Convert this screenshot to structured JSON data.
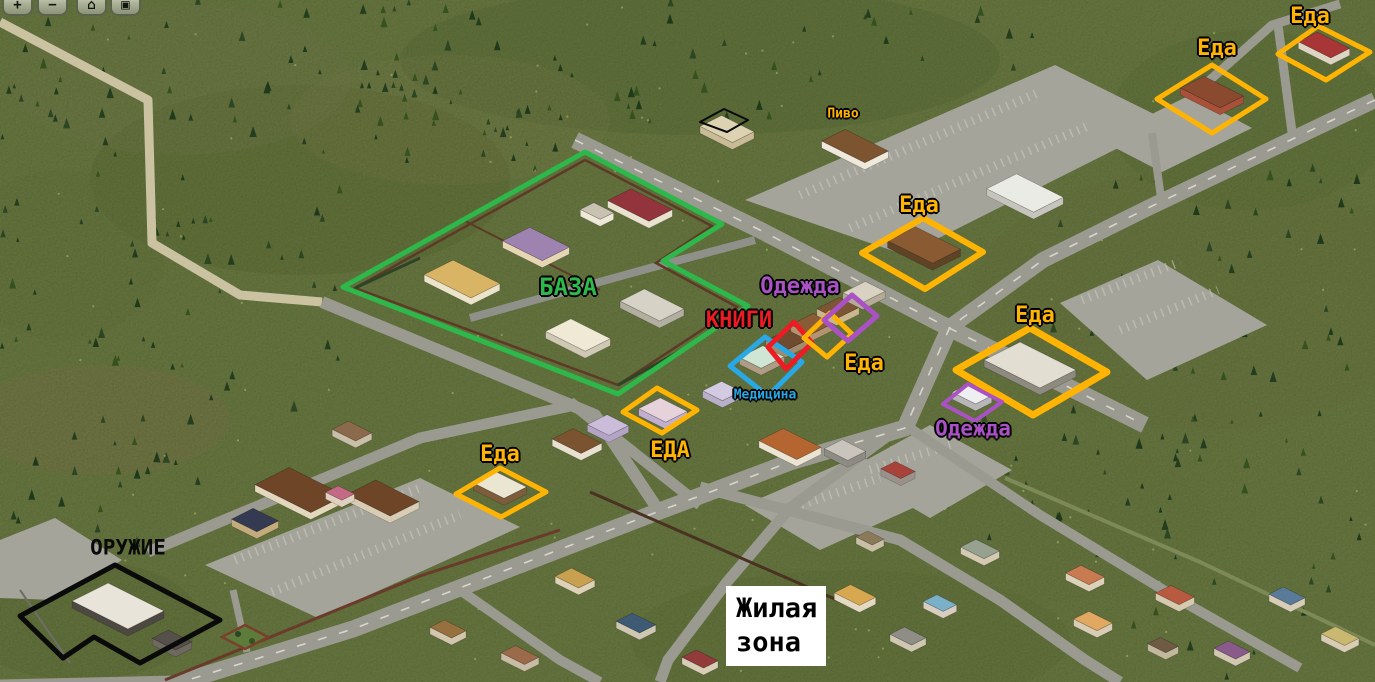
{
  "toolbar": {
    "buttons": [
      {
        "name": "zoom-in",
        "glyph": "+"
      },
      {
        "name": "zoom-out",
        "glyph": "−"
      },
      {
        "name": "home",
        "glyph": "⌂"
      },
      {
        "name": "save",
        "glyph": "▣"
      }
    ]
  },
  "palette": {
    "yellow": "#FFB404",
    "green": "#2EB84B",
    "red": "#ED1C24",
    "blue": "#29A8E6",
    "purple": "#AA52C5",
    "black": "#0A0A0A",
    "white": "#FFFFFF"
  },
  "annotations": {
    "outlines": [
      {
        "id": "base-outline",
        "color_key": "green",
        "width": 5,
        "points": [
          [
            585,
            152
          ],
          [
            722,
            224
          ],
          [
            663,
            261
          ],
          [
            748,
            306
          ],
          [
            618,
            394
          ],
          [
            343,
            287
          ]
        ]
      },
      {
        "id": "food-store-topright-outline",
        "color_key": "yellow",
        "width": 5,
        "points": [
          [
            1278,
            54
          ],
          [
            1318,
            26
          ],
          [
            1370,
            52
          ],
          [
            1326,
            80
          ]
        ]
      },
      {
        "id": "food-store-right-outline",
        "color_key": "yellow",
        "width": 5,
        "points": [
          [
            1157,
            99
          ],
          [
            1212,
            65
          ],
          [
            1266,
            99
          ],
          [
            1212,
            133
          ]
        ]
      },
      {
        "id": "food-restaurant-outline",
        "color_key": "yellow",
        "width": 6,
        "points": [
          [
            862,
            253
          ],
          [
            923,
            218
          ],
          [
            983,
            252
          ],
          [
            925,
            289
          ]
        ]
      },
      {
        "id": "medicine-outline",
        "color_key": "blue",
        "width": 5,
        "points": [
          [
            730,
            366
          ],
          [
            765,
            337
          ],
          [
            802,
            362
          ],
          [
            768,
            396
          ]
        ]
      },
      {
        "id": "books-outline",
        "color_key": "red",
        "width": 5,
        "points": [
          [
            768,
            347
          ],
          [
            794,
            322
          ],
          [
            812,
            343
          ],
          [
            786,
            369
          ]
        ]
      },
      {
        "id": "food-strip-outline",
        "color_key": "yellow",
        "width": 5,
        "points": [
          [
            804,
            338
          ],
          [
            830,
            313
          ],
          [
            852,
            334
          ],
          [
            827,
            357
          ]
        ]
      },
      {
        "id": "clothes-strip-outline",
        "color_key": "purple",
        "width": 5,
        "points": [
          [
            824,
            320
          ],
          [
            852,
            295
          ],
          [
            877,
            316
          ],
          [
            848,
            341
          ]
        ]
      },
      {
        "id": "food-supermarket-outline",
        "color_key": "yellow",
        "width": 7,
        "points": [
          [
            956,
            370
          ],
          [
            1030,
            328
          ],
          [
            1107,
            372
          ],
          [
            1033,
            415
          ]
        ]
      },
      {
        "id": "clothes-supermarket-outline",
        "color_key": "purple",
        "width": 4,
        "points": [
          [
            943,
            404
          ],
          [
            968,
            384
          ],
          [
            1002,
            402
          ],
          [
            975,
            421
          ]
        ]
      },
      {
        "id": "food-strip-b-outline",
        "color_key": "yellow",
        "width": 5,
        "points": [
          [
            623,
            412
          ],
          [
            657,
            388
          ],
          [
            697,
            410
          ],
          [
            662,
            433
          ]
        ]
      },
      {
        "id": "food-house-outline",
        "color_key": "yellow",
        "width": 5,
        "points": [
          [
            456,
            494
          ],
          [
            500,
            468
          ],
          [
            546,
            492
          ],
          [
            501,
            517
          ]
        ]
      },
      {
        "id": "weapons-outline",
        "color_key": "black",
        "width": 5,
        "points": [
          [
            115,
            565
          ],
          [
            220,
            620
          ],
          [
            140,
            663
          ],
          [
            94,
            637
          ],
          [
            63,
            658
          ],
          [
            20,
            616
          ]
        ]
      },
      {
        "id": "roof-marker-outline",
        "color_key": "black",
        "width": 2,
        "points": [
          [
            700,
            122
          ],
          [
            724,
            109
          ],
          [
            748,
            120
          ],
          [
            727,
            132
          ]
        ]
      }
    ],
    "labels": [
      {
        "id": "label-food-topright",
        "text": "Еда",
        "color_key": "yellow",
        "x": 1310,
        "y": 17,
        "size": 22
      },
      {
        "id": "label-food-right",
        "text": "Еда",
        "color_key": "yellow",
        "x": 1217,
        "y": 49,
        "size": 22
      },
      {
        "id": "label-beer",
        "text": "Пиво",
        "color_key": "yellow",
        "x": 843,
        "y": 114,
        "size": 13
      },
      {
        "id": "label-food-restaurant",
        "text": "Еда",
        "color_key": "yellow",
        "x": 919,
        "y": 206,
        "size": 22
      },
      {
        "id": "label-base",
        "text": "БАЗА",
        "color_key": "green",
        "x": 568,
        "y": 287,
        "size": 24
      },
      {
        "id": "label-clothes-strip",
        "text": "Одежда",
        "color_key": "purple",
        "x": 800,
        "y": 287,
        "size": 22
      },
      {
        "id": "label-books",
        "text": "КНИГИ",
        "color_key": "red",
        "x": 739,
        "y": 321,
        "size": 22
      },
      {
        "id": "label-food-strip",
        "text": "Еда",
        "color_key": "yellow",
        "x": 864,
        "y": 364,
        "size": 22
      },
      {
        "id": "label-medicine",
        "text": "Медицина",
        "color_key": "blue",
        "x": 765,
        "y": 395,
        "size": 13
      },
      {
        "id": "label-food-supermarket",
        "text": "Еда",
        "color_key": "yellow",
        "x": 1035,
        "y": 316,
        "size": 22
      },
      {
        "id": "label-clothes-supermarket",
        "text": "Одежда",
        "color_key": "purple",
        "x": 973,
        "y": 429,
        "size": 21
      },
      {
        "id": "label-food-strip-b",
        "text": "ЕДА",
        "color_key": "yellow",
        "x": 670,
        "y": 451,
        "size": 22
      },
      {
        "id": "label-food-house",
        "text": "Еда",
        "color_key": "yellow",
        "x": 500,
        "y": 455,
        "size": 22
      },
      {
        "id": "label-weapons",
        "text": "ОРУЖИЕ",
        "color_key": "black",
        "x": 128,
        "y": 548,
        "size": 21,
        "outline": false
      }
    ],
    "zone_box": {
      "id": "residential-zone-box",
      "lines": [
        "Жилая",
        "зона"
      ],
      "x": 726,
      "y": 586,
      "w": 100,
      "h": 80
    }
  }
}
